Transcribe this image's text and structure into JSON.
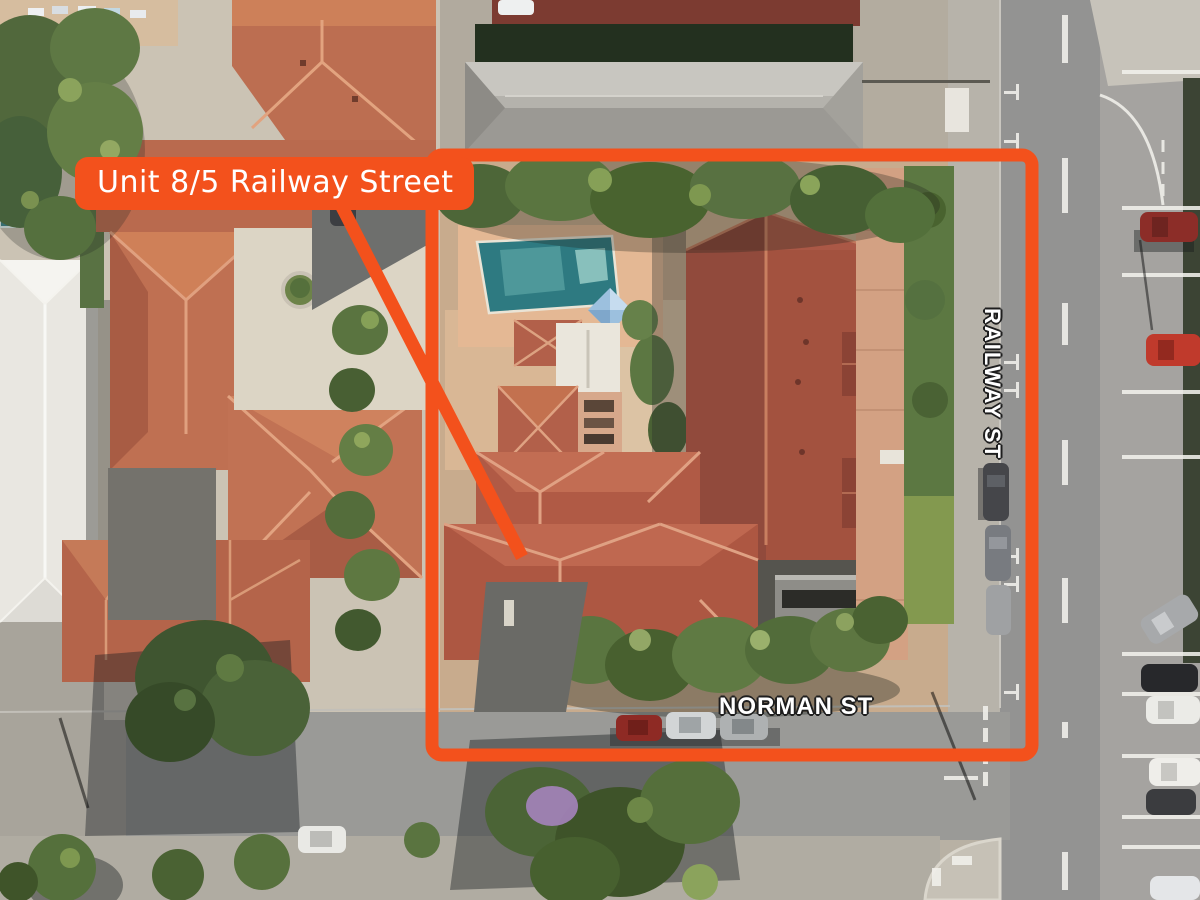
{
  "annotation": {
    "property_label": "Unit 8/5 Railway Street"
  },
  "streets": {
    "railway": "RAILWAY ST",
    "norman": "NORMAN ST"
  },
  "colors": {
    "annotation_orange": "#F3511C",
    "pool_teal": "#2E7A81",
    "roof_terracotta": "#B05A45",
    "roof_dark": "#9B4E3F",
    "road_gray": "#939392"
  }
}
